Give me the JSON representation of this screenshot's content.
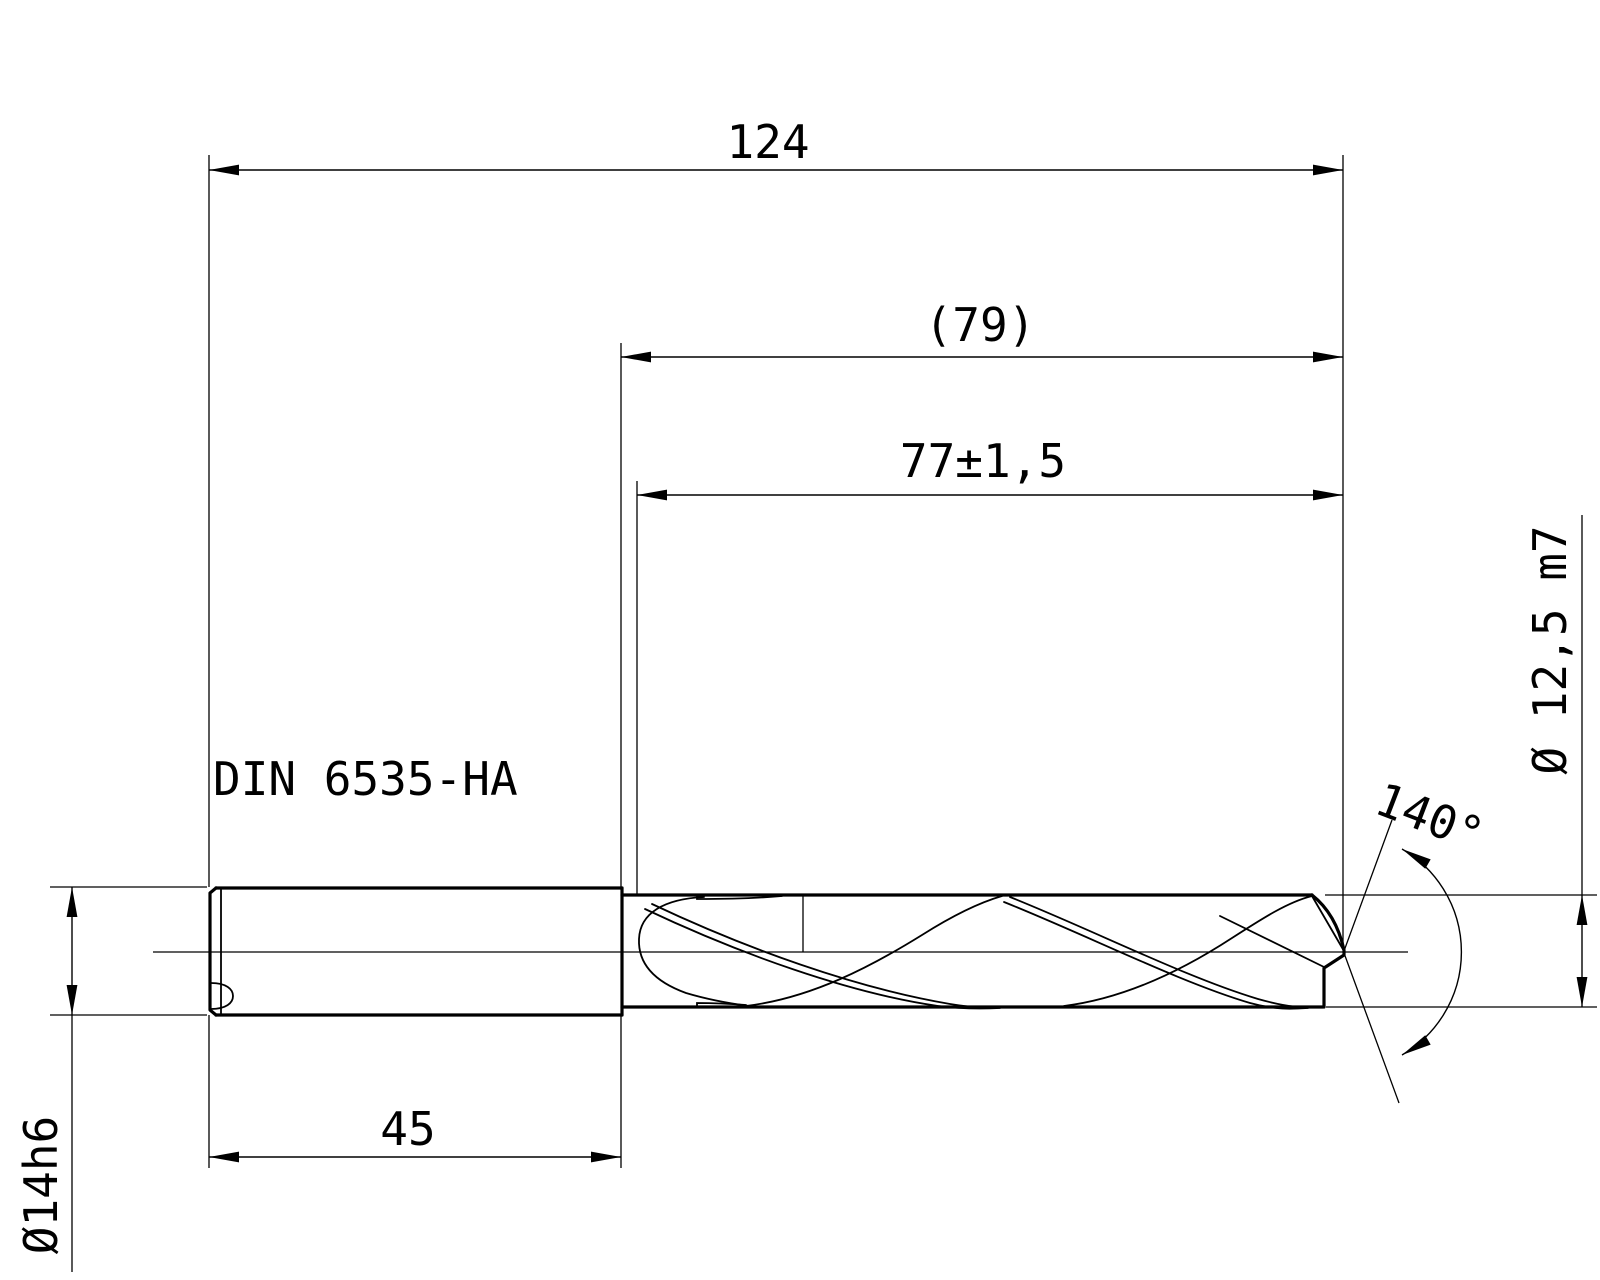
{
  "drawing": {
    "colors": {
      "line": "#000000",
      "background": "#ffffff"
    },
    "dimensions": {
      "overall_length": "124",
      "flute_length_ref": "(79)",
      "usable_length": "77±1,5",
      "shank_length": "45",
      "shank_diameter": "Ø14h6",
      "cutting_diameter": "Ø 12,5 m7",
      "point_angle": "140°"
    },
    "annotations": {
      "shank_standard": "DIN 6535-HA"
    }
  }
}
